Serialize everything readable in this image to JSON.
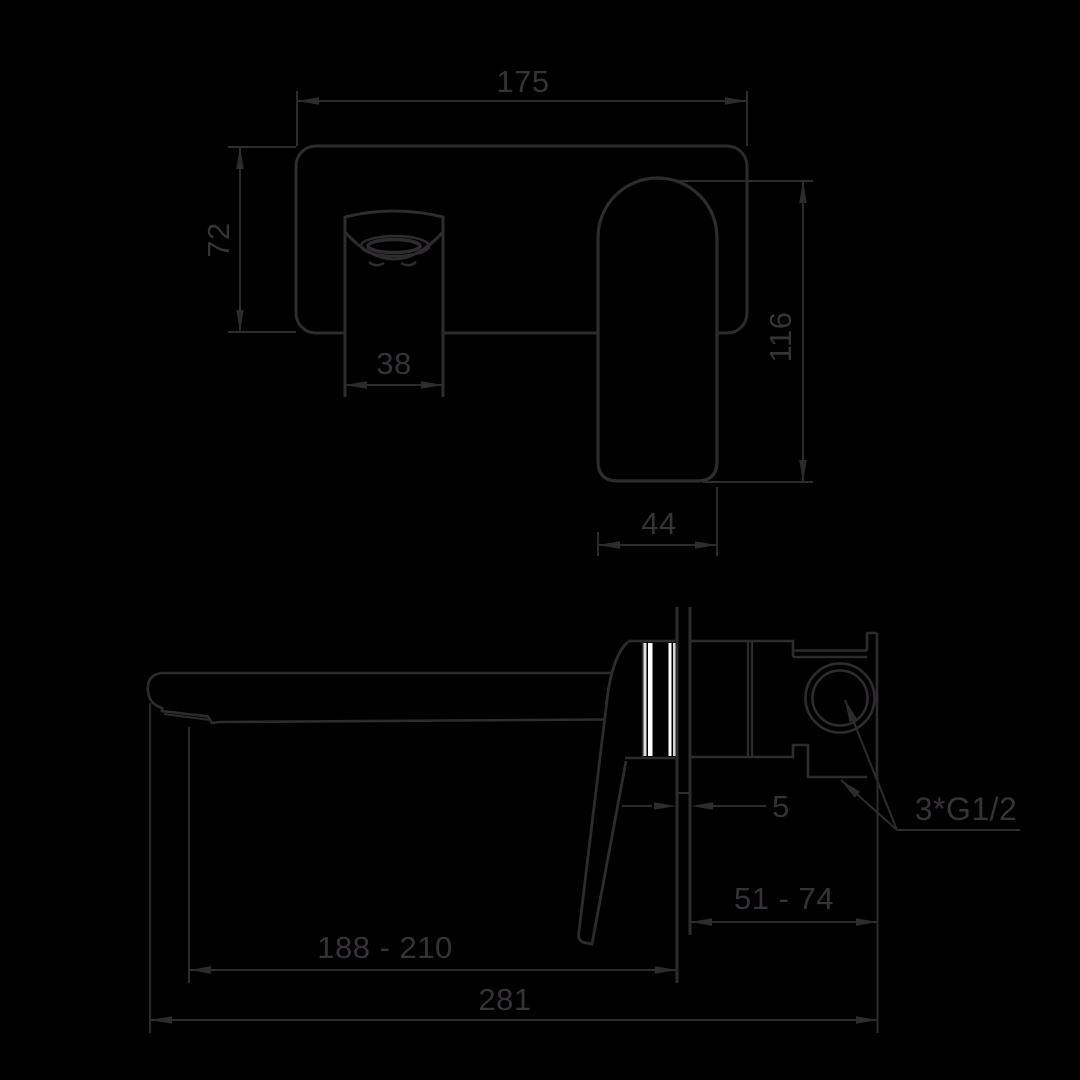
{
  "drawing": {
    "background_color": "#000000",
    "line_color": "#2e2b2e",
    "highlight_color": "#ffffff",
    "subject": "wall-mounted basin mixer technical dimension drawing",
    "views": [
      {
        "id": "front-view",
        "description": "wall plate with spout and lever handle"
      },
      {
        "id": "side-view",
        "description": "spout projection and concealed body section"
      }
    ]
  },
  "dims": {
    "plate_width": "175",
    "plate_height": "72",
    "spout_width": "38",
    "handle_length": "116",
    "handle_width": "44",
    "wall_sleeve": "5",
    "thread": "3*G1/2",
    "in_wall_depth": "51 - 74",
    "spout_reach": "188 - 210",
    "total_depth": "281"
  }
}
